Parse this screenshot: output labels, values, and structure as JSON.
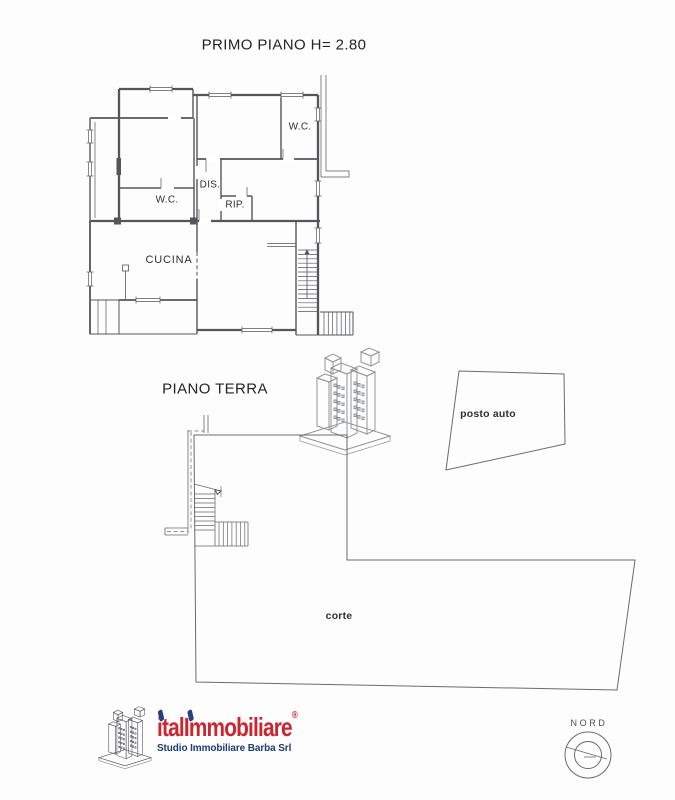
{
  "document": {
    "first_floor": {
      "title": "PRIMO PIANO H= 2.80",
      "rooms": {
        "wc_top": "W.C.",
        "dis": "DIS.",
        "rip": "RIP.",
        "wc_left": "W.C.",
        "cucina": "CUCINA"
      }
    },
    "ground_floor": {
      "title": "PIANO TERRA",
      "areas": {
        "posto_auto": "posto auto",
        "corte": "corte"
      }
    },
    "compass": {
      "label": "NORD"
    },
    "logo": {
      "brand_first": "ital",
      "brand_second": "Immobiliare",
      "registered": "®",
      "subtitle": "Studio Immobiliare Barba Srl"
    },
    "colors": {
      "plan_line": "#55565a",
      "label_text": "#2f2f33",
      "brand_red": "#cb2630",
      "brand_blue": "#1e3b78",
      "watermark_red": "#d84a55",
      "watermark_blue": "#44609f",
      "watermark_base": "#dfe5f1"
    }
  }
}
